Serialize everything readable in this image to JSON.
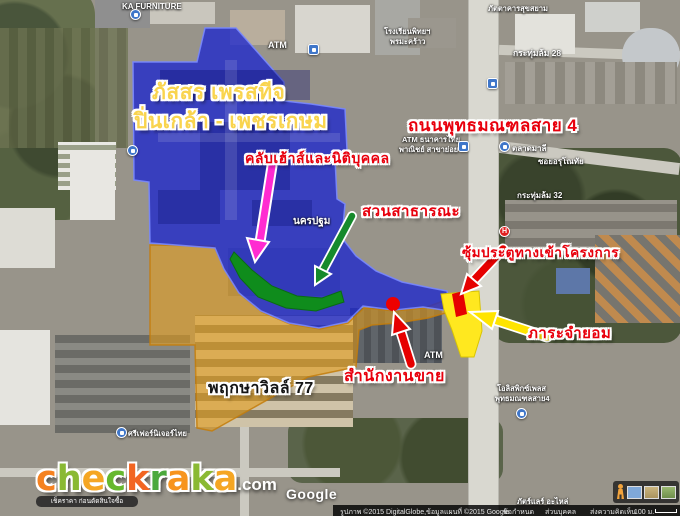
{
  "map": {
    "project_labels": {
      "passorn_line1": "ภัสสร เพรสทีจ",
      "passorn_line2": "ปิ่นเกล้า - เพชรเกษม",
      "pruksa": "พฤกษาวิลล์ 77"
    },
    "annotations": {
      "road": "ถนนพุทธมณฑลสาย 4",
      "clubhouse": "คลับเฮ้าส์และนิติบุคคล",
      "park": "สวนสาธารณะ",
      "gate": "ซุ้มประตูทางเข้าโครงการ",
      "easement": "ภาระจำยอม",
      "sales_office": "สำนักงานขาย"
    },
    "place_labels": [
      {
        "text": "KA FURNITURE",
        "x": 122,
        "y": 2,
        "size": 8
      },
      {
        "text": "ATM",
        "x": 268,
        "y": 40,
        "size": 9
      },
      {
        "text": "โรงเรียนพิทยฯ",
        "x": 384,
        "y": 26,
        "size": 7.5
      },
      {
        "text": "พรมะคร้าว",
        "x": 390,
        "y": 36,
        "size": 7.5
      },
      {
        "text": "ภัตตาคารสุขสยาม",
        "x": 488,
        "y": 3,
        "size": 7.5
      },
      {
        "text": "กระทุ่มล้ม 28",
        "x": 513,
        "y": 46,
        "size": 8.5
      },
      {
        "text": "ATM ธนาคารไทย",
        "x": 402,
        "y": 134,
        "size": 7.5
      },
      {
        "text": "พาณิชย์ สาขาย่อย",
        "x": 399,
        "y": 144,
        "size": 7.5
      },
      {
        "text": "ตลาดมาลี",
        "x": 512,
        "y": 142,
        "size": 8
      },
      {
        "text": "ซอยอรุโณทัย",
        "x": 538,
        "y": 155,
        "size": 8
      },
      {
        "text": "กระทุ่มล้ม 32",
        "x": 517,
        "y": 189,
        "size": 8
      },
      {
        "text": "29",
        "x": 441,
        "y": 208,
        "size": 8
      },
      {
        "text": "นครปฐม",
        "x": 293,
        "y": 214,
        "size": 10
      },
      {
        "text": "ATM",
        "x": 424,
        "y": 350,
        "size": 9
      },
      {
        "text": "โอลิสพิกซ์เพลส",
        "x": 497,
        "y": 383,
        "size": 7.5
      },
      {
        "text": "พุทธมณฑลสาย4",
        "x": 495,
        "y": 393,
        "size": 7.5
      },
      {
        "text": "ศรีเฟอร์นิเจอร์ไทย",
        "x": 128,
        "y": 428,
        "size": 7.5
      },
      {
        "text": "ภัตร์แลร์ อะไหล่",
        "x": 517,
        "y": 496,
        "size": 7.5
      }
    ],
    "icons": [
      {
        "kind": "shop-bag",
        "x": 130,
        "y": 9
      },
      {
        "kind": "bank",
        "x": 308,
        "y": 44
      },
      {
        "kind": "shop-bag",
        "x": 127,
        "y": 145
      },
      {
        "kind": "bus",
        "x": 487,
        "y": 78
      },
      {
        "kind": "bank",
        "x": 458,
        "y": 141
      },
      {
        "kind": "shop-cart",
        "x": 499,
        "y": 141
      },
      {
        "kind": "hospital",
        "x": 499,
        "y": 226,
        "glyph": "H"
      },
      {
        "kind": "lodging",
        "x": 516,
        "y": 408
      },
      {
        "kind": "shop-bag",
        "x": 116,
        "y": 427
      }
    ]
  },
  "watermark": "Google",
  "logo": {
    "letters": [
      {
        "ch": "c",
        "color": "#f58220"
      },
      {
        "ch": "h",
        "color": "#8ab933"
      },
      {
        "ch": "e",
        "color": "#f5a623"
      },
      {
        "ch": "c",
        "color": "#66b82e"
      },
      {
        "ch": "k",
        "color": "#f26522"
      },
      {
        "ch": "r",
        "color": "#4ba93c"
      },
      {
        "ch": "a",
        "color": "#f7941d"
      },
      {
        "ch": "k",
        "color": "#8ab933"
      },
      {
        "ch": "a",
        "color": "#f5a623"
      }
    ],
    "tld": ".com",
    "tagline": "เช็คราคา ก่อนตัดสินใจซื้อ"
  },
  "footer": {
    "attribution": "รูปภาพ ©2015 DigitalGlobe,ข้อมูลแผนที่ ©2015 Google",
    "terms": "ข้อกำหนด",
    "privacy": "ส่วนบุคคล",
    "feedback": "ส่งความคิดเห็น",
    "scale": "100 ม."
  },
  "colors": {
    "project_area_blue": "#1e28cd",
    "pruksa_area_orange": "#e6a01e",
    "park_green": "#0f8c1c",
    "easement_yellow": "#ffe81f",
    "annotation_red": "#e8000d",
    "title_gold": "#f9d44e",
    "marker_red": "#ee0000",
    "arrow_magenta": "#ff2bd1"
  }
}
